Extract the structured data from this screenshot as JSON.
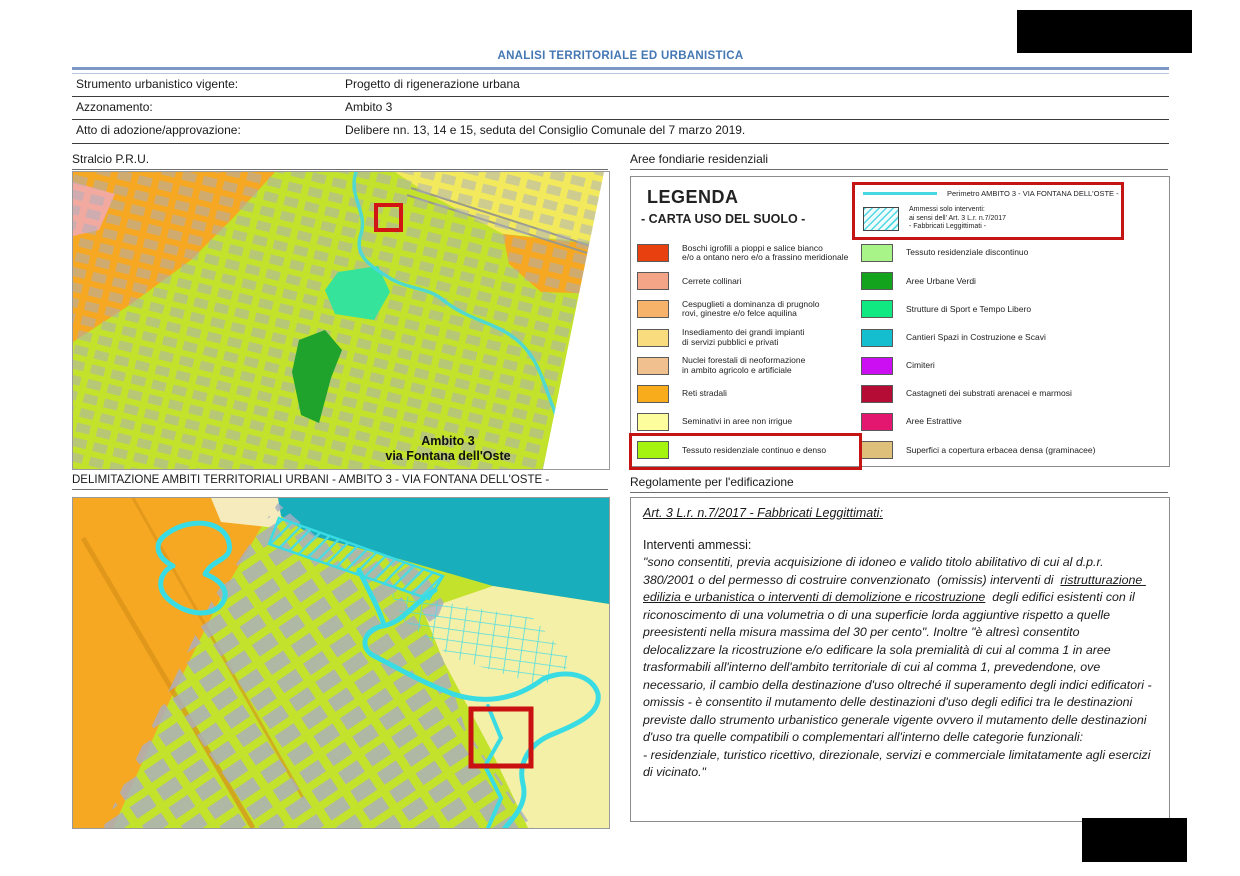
{
  "header": {
    "title": "ANALISI TERRITORIALE ED URBANISTICA"
  },
  "info_table": {
    "rows": [
      {
        "label": "Strumento urbanistico vigente:",
        "value": "Progetto di rigenerazione urbana"
      },
      {
        "label": "Azzonamento:",
        "value": "Ambito 3"
      },
      {
        "label": "Atto di adozione/approvazione:",
        "value": "Delibere nn. 13, 14 e 15, seduta del Consiglio Comunale del 7 marzo 2019."
      }
    ]
  },
  "sections": {
    "pru_title": "Stralcio P.R.U.",
    "aree_title": "Aree fondiarie residenziali",
    "delimitazione_title": "DELIMITAZIONE AMBITI TERRITORIALI URBANI - AMBITO 3 - VIA FONTANA DELL'OSTE -",
    "regolamento_title": "Regolamente per l'edificazione"
  },
  "maps": {
    "pru": {
      "label_line1": "Ambito  3",
      "label_line2": "via Fontana dell'Oste",
      "marker": "red-rectangle",
      "perimeter_color": "#45D8E0"
    },
    "delimitazione": {
      "marker": "red-rectangle",
      "perimeter_color": "#3ADCE4"
    }
  },
  "legend": {
    "title": "LEGENDA",
    "subtitle": "- CARTA USO DEL SUOLO -",
    "highlight_box": {
      "perimeter_label": "Perimetro AMBITO 3 - VIA FONTANA DELL'OSTE -",
      "perimeter_color": "#45D8E0",
      "hatch_label": "Ammessi solo interventi:\nai sensi dell' Art. 3 L.r.  n.7/2017\n- Fabbricati Leggittimati -",
      "frame_color": "#C41414"
    },
    "left_items": [
      {
        "color": "#E8400E",
        "label": "Boschi igrofili a pioppi e salice bianco\ne/o a ontano nero e/o a frassino meridionale",
        "highlighted": false
      },
      {
        "color": "#F4A588",
        "label": "Cerrete collinari",
        "highlighted": false
      },
      {
        "color": "#F8B36A",
        "label": "Cespuglieti a dominanza di prugnolo\nrovi, ginestre e/o felce aquilina",
        "highlighted": false
      },
      {
        "color": "#F8DC7E",
        "label": "Insediamento dei grandi impianti\ndi servizi pubblici e privati",
        "highlighted": false
      },
      {
        "color": "#F0C08E",
        "label": "Nuclei forestali di neoformazione\nin ambito agricolo e artificiale",
        "highlighted": false
      },
      {
        "color": "#F8AC1C",
        "label": "Reti stradali",
        "highlighted": false
      },
      {
        "color": "#FDFD9E",
        "label": "Seminativi in aree non irrigue",
        "highlighted": false
      },
      {
        "color": "#A4F410",
        "label": "Tessuto residenziale continuo e denso",
        "highlighted": true
      }
    ],
    "right_items": [
      {
        "color": "#A8F488",
        "label": "Tessuto residenziale discontinuo"
      },
      {
        "color": "#14A31C",
        "label": "Aree Urbane Verdi"
      },
      {
        "color": "#10E882",
        "label": "Strutture di Sport e Tempo Libero"
      },
      {
        "color": "#14BECE",
        "label": "Cantieri Spazi in Costruzione e Scavi"
      },
      {
        "color": "#CB0FF2",
        "label": "Cimiteri"
      },
      {
        "color": "#B40C34",
        "label": "Castagneti dei substrati arenacei e marmosi"
      },
      {
        "color": "#E3176F",
        "label": "Aree Estrattive"
      },
      {
        "color": "#DEC07A",
        "label": "Superfici a copertura erbacea densa (graminacee)"
      }
    ]
  },
  "regulation": {
    "heading": "Art. 3 L.r. n.7/2017 - Fabbricati Leggittimati:",
    "subheading": "Interventi ammessi:",
    "segments": [
      {
        "t": "\"sono consentiti, previa acquisizione di idoneo e valido titolo abilitativo di cui al d.p.r. 380/2001 o del permesso di costruire convenzionato  (omissis) interventi di  ",
        "u": false
      },
      {
        "t": "ristrutturazione edilizia e urbanistica o interventi di demolizione e ricostruzione",
        "u": true
      },
      {
        "t": "  degli edifici esistenti con il riconoscimento di una volumetria o di una superficie lorda aggiuntive rispetto a quelle preesistenti nella misura massima del 30 per cento\". Inoltre \"è altresì consentito delocalizzare la ricostruzione e/o edificare la sola premialità di cui al comma 1 in aree trasformabili all'interno dell'ambito territoriale di cui al comma 1, prevedendone, ove necessario, il cambio della destinazione d'uso oltreché il superamento degli indici edificatori -  omissis - è consentito il mutamento delle destinazioni d'uso degli edifici tra le destinazioni previste dallo strumento urbanistico generale vigente ovvero il mutamento delle destinazioni d'uso tra quelle compatibili o complementari all'interno delle categorie funzionali:\n- residenziale, turistico ricettivo, direzionale, servizi e commerciale limitatamente agli esercizi di vicinato.\"",
        "u": false
      }
    ]
  }
}
